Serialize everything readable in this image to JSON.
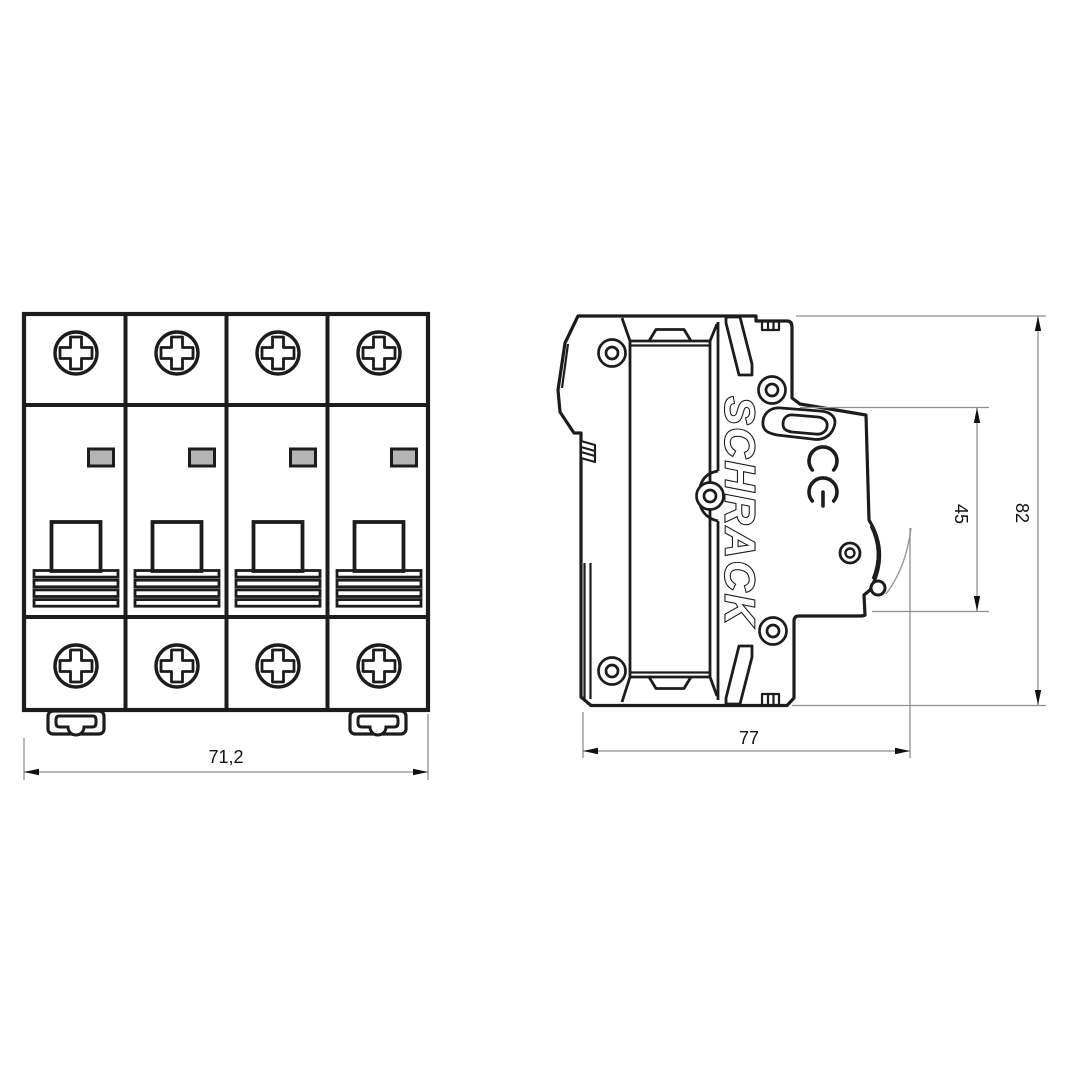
{
  "drawing": {
    "brand": "SCHRACK",
    "ce_mark": "CE",
    "view_type": "dimension drawing"
  },
  "dimensions": {
    "front_width": "71,2",
    "side_depth": "77",
    "front_face_height": "45",
    "side_total_height": "82"
  },
  "colors": {
    "line": "#1c1c1c",
    "dimension_line": "#8e8e8e",
    "indicator_window_fill": "#b4b4b4",
    "background": "#ffffff"
  }
}
